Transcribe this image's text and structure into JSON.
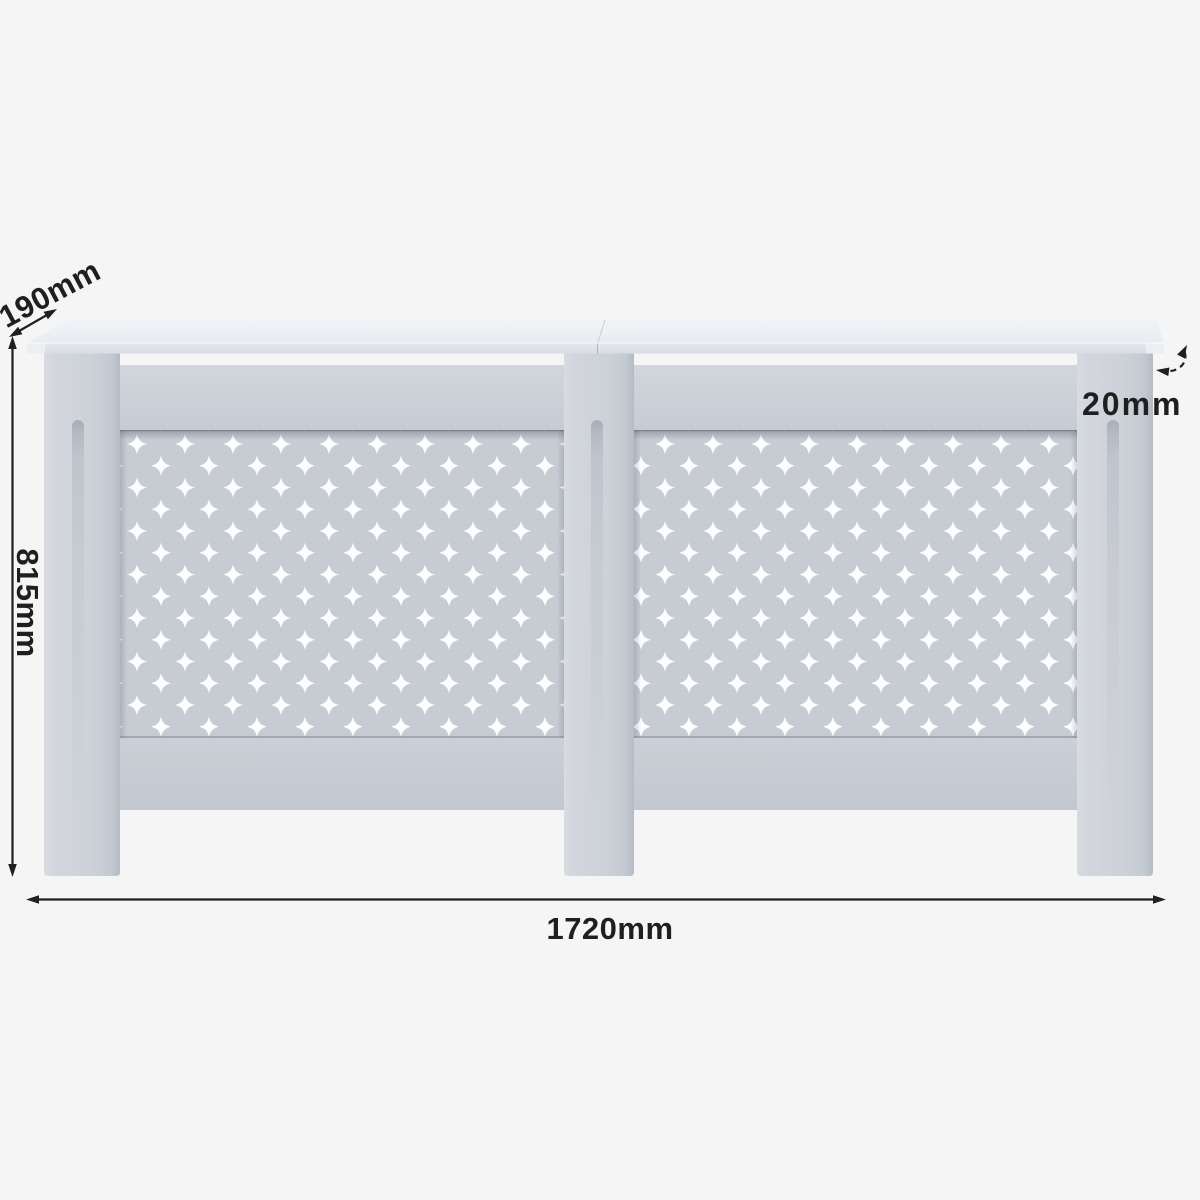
{
  "dimensions": {
    "depth_label": "190mm",
    "height_label": "815mm",
    "width_label": "1720mm",
    "thickness_label": "20mm"
  },
  "colors": {
    "background": "#f5f5f6",
    "top_board_white": "#edf0f4",
    "frame_grey": "#ced3d9",
    "panel_grey": "#c7ccd3",
    "lattice_cutout_white": "#fbfdfe",
    "annotation_black": "#1f1f1f"
  }
}
